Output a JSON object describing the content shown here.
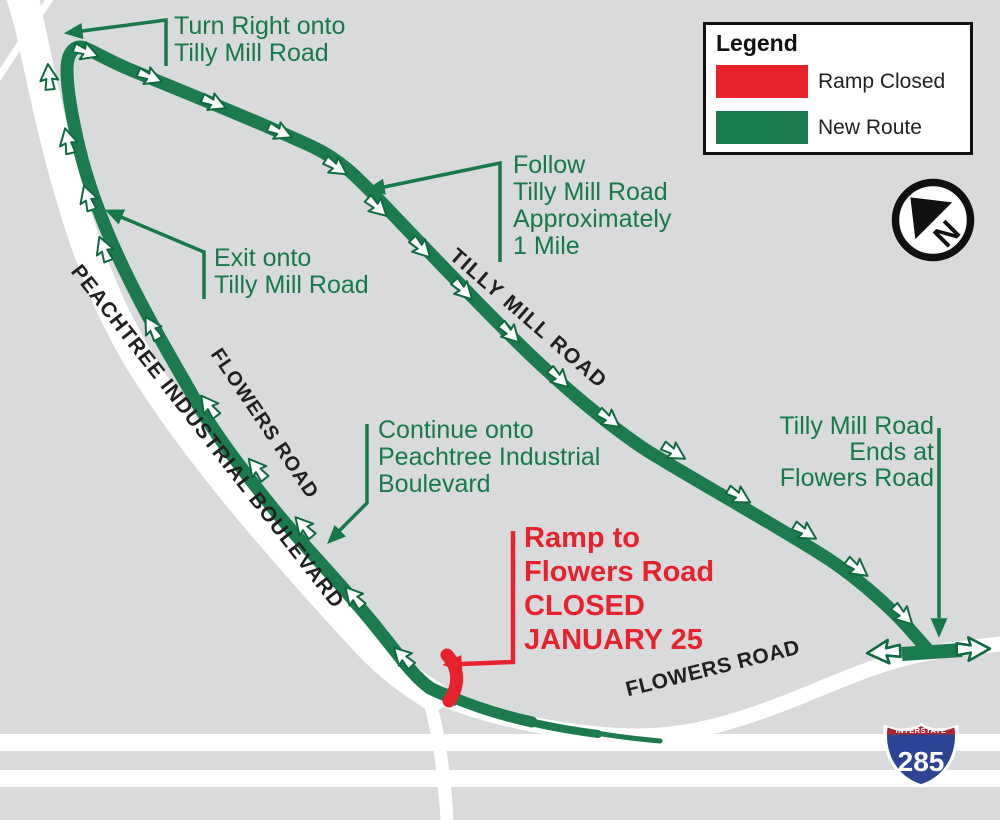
{
  "legend": {
    "title": "Legend",
    "items": [
      {
        "label": "Ramp Closed",
        "color": "#e8222c"
      },
      {
        "label": "New Route",
        "color": "#1b7b4e"
      }
    ]
  },
  "north_indicator": {
    "letter": "N"
  },
  "annotations": {
    "turn_right": {
      "lines": [
        "Turn Right onto",
        "Tilly Mill Road"
      ]
    },
    "follow": {
      "lines": [
        "Follow",
        "Tilly Mill Road",
        "Approximately",
        "1 Mile"
      ]
    },
    "exit": {
      "lines": [
        "Exit onto",
        "Tilly Mill Road"
      ]
    },
    "continue_onto": {
      "lines": [
        "Continue onto",
        "Peachtree Industrial",
        "Boulevard"
      ]
    },
    "ends_at": {
      "lines": [
        "Tilly Mill Road",
        "Ends at",
        "Flowers Road"
      ]
    }
  },
  "closure": {
    "lines": [
      "Ramp to",
      "Flowers Road",
      "CLOSED",
      "JANUARY 25"
    ]
  },
  "road_labels": {
    "peachtree": "PEACHTREE INDUSTRIAL BOULEVARD",
    "flowers_west": "FLOWERS ROAD",
    "tilly_mill": "TILLY MILL ROAD",
    "flowers_east": "FLOWERS ROAD"
  },
  "interstate_shield": {
    "top": "INTERSTATE",
    "number": "285"
  },
  "colors": {
    "background": "#d9dadb",
    "road_white": "#ffffff",
    "route_green": "#1b7b4e",
    "annotation_green": "#15794a",
    "closed_red": "#e8222c",
    "label_black": "#231f20",
    "shield_blue": "#2d4494",
    "shield_red": "#b52231"
  }
}
